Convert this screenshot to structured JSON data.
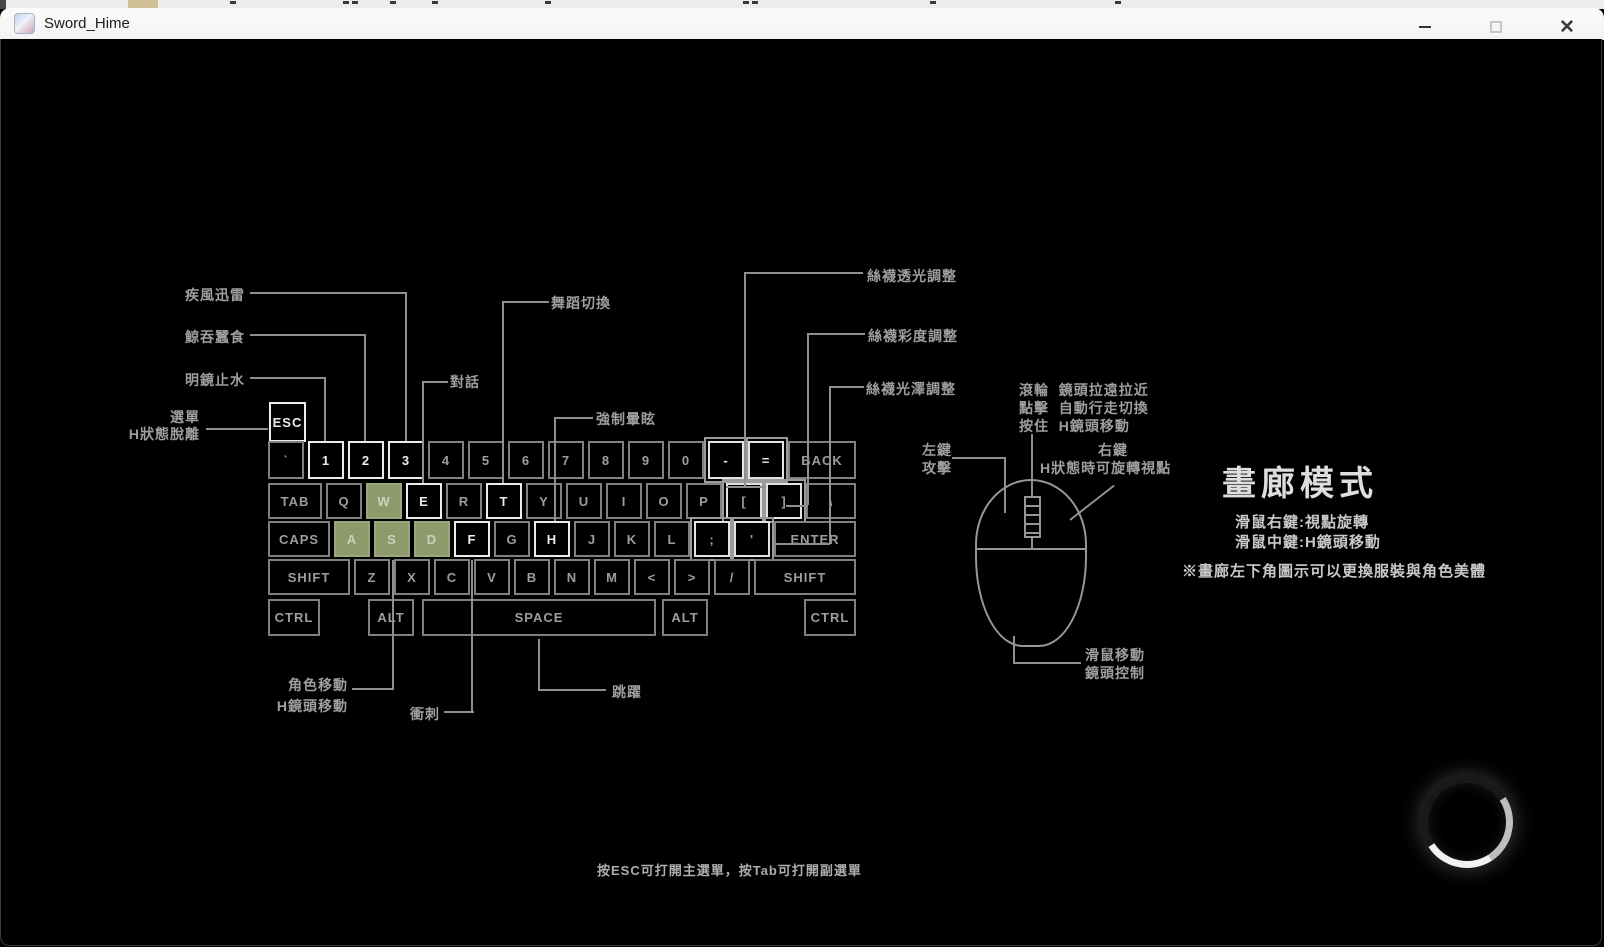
{
  "window": {
    "title": "Sword_Hime",
    "controls": {
      "close_glyph": "✕"
    }
  },
  "keyboard": {
    "esc": "ESC",
    "rows": [
      [
        "`",
        "1",
        "2",
        "3",
        "4",
        "5",
        "6",
        "7",
        "8",
        "9",
        "0",
        "-",
        "=",
        "BACK"
      ],
      [
        "TAB",
        "Q",
        "W",
        "E",
        "R",
        "T",
        "Y",
        "U",
        "I",
        "O",
        "P",
        "[",
        "]",
        "\\"
      ],
      [
        "CAPS",
        "A",
        "S",
        "D",
        "F",
        "G",
        "H",
        "J",
        "K",
        "L",
        ";",
        "'",
        "ENTER"
      ],
      [
        "SHIFT",
        "Z",
        "X",
        "C",
        "V",
        "B",
        "N",
        "M",
        "<",
        ">",
        "/",
        "SHIFT"
      ],
      [
        "CTRL",
        "ALT",
        "SPACE",
        "ALT",
        "CTRL"
      ]
    ],
    "wasd_keys": [
      "W",
      "A",
      "S",
      "D"
    ],
    "bold_keys": [
      "ESC",
      "1",
      "2",
      "3",
      "E",
      "T",
      "F",
      "H",
      "-",
      "="
    ],
    "adjust_keys": [
      "-",
      "=",
      "[",
      "]",
      ";",
      "'"
    ],
    "wasd_color": "#8e9a6c"
  },
  "callouts": {
    "skill1": "疾風迅雷",
    "skill2": "鯨吞蠶食",
    "skill3": "明鏡止水",
    "menu_line1": "選單",
    "menu_line2": "H狀態脫離",
    "dialog": "對話",
    "dance": "舞蹈切換",
    "stun": "強制暈眩",
    "stocking_translucency": "絲襪透光調整",
    "stocking_saturation": "絲襪彩度調整",
    "stocking_gloss": "絲襪光澤調整",
    "move_line1": "角色移動",
    "move_line2": "H鏡頭移動",
    "dash": "衝刺",
    "jump": "跳躍"
  },
  "mouse": {
    "wheel_rows": [
      {
        "k": "滾輪",
        "v": "鏡頭拉遠拉近"
      },
      {
        "k": "點擊",
        "v": "自動行走切換"
      },
      {
        "k": "按住",
        "v": "H鏡頭移動"
      }
    ],
    "left_line1": "左鍵",
    "left_line2": "攻擊",
    "right_line1": "右鍵",
    "right_line2": "H狀態時可旋轉視點",
    "move_line1": "滑鼠移動",
    "move_line2": "鏡頭控制"
  },
  "gallery": {
    "title": "畫廊模式",
    "hint1": "滑鼠右鍵:視點旋轉",
    "hint2": "滑鼠中鍵:H鏡頭移動",
    "note": "※畫廊左下角圖示可以更換服裝與角色美體"
  },
  "footer": {
    "hint": "按ESC可打開主選單，按Tab可打開副選單"
  }
}
